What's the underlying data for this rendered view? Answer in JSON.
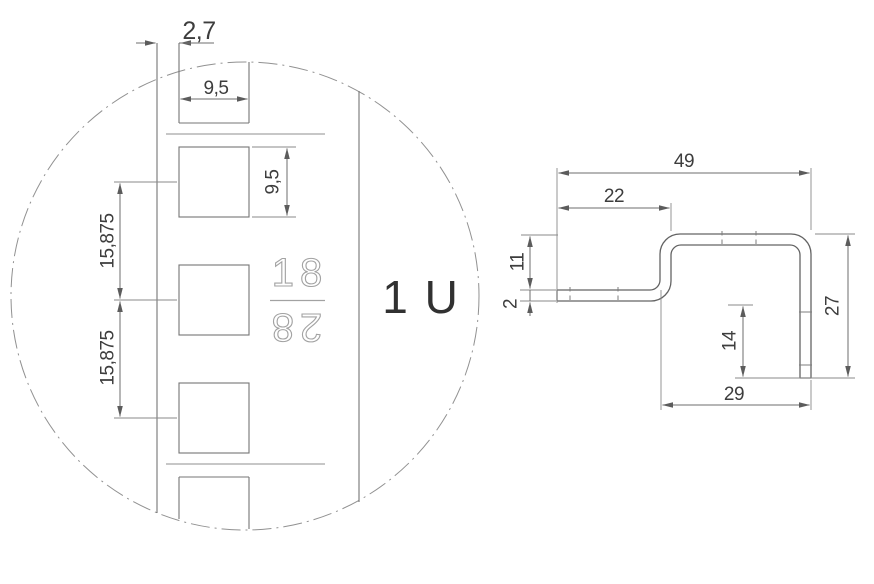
{
  "left_view": {
    "dim_edge_offset": "2,7",
    "dim_hole_width": "9,5",
    "dim_hole_height": "9,5",
    "dim_pitch_upper": "15,875",
    "dim_pitch_lower": "15,875",
    "hole_number_top": "18",
    "hole_number_bottom": "28",
    "unit_label": "1 U"
  },
  "right_view": {
    "dim_overall_width": "49",
    "dim_upper_flange_width": "22",
    "dim_step_height": "11",
    "dim_material_thickness": "2",
    "dim_leg_extension": "14",
    "dim_lower_width": "29",
    "dim_overall_height": "27"
  },
  "colors": {
    "background": "#ffffff",
    "geometry_line": "#757575",
    "dimension_line": "#6e6e6e",
    "text": "#3d3d3d",
    "outline_digits": "#a2a2a2"
  }
}
